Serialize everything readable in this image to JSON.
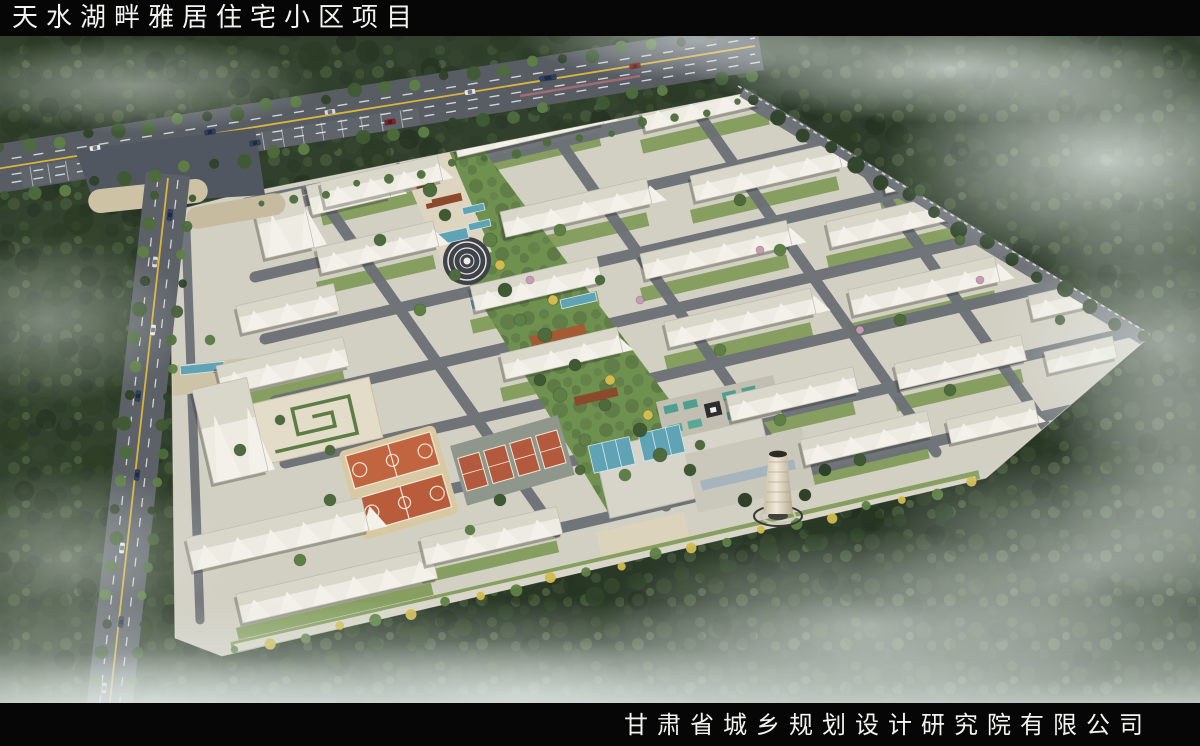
{
  "header": {
    "title": "天水湖畔雅居住宅小区项目"
  },
  "footer": {
    "company": "甘肃省城乡规划设计研究院有限公司"
  },
  "palette": {
    "bar_black": "#060606",
    "title_white": "#f3f3f0",
    "forest_green": "#31402c",
    "site_gray": "#d2cfc3",
    "road_gray": "#5a5f66",
    "lane_yellow": "#d9b53c",
    "lawn_green": "#7d9955",
    "pool_blue": "#5fa3b5",
    "court_orange": "#c0653f",
    "tennis_red": "#b35a3e",
    "pavilion_brown": "#8c4a2c",
    "fog_white": "#eef4f1"
  },
  "scene": {
    "treeColors": [
      "#3f5a33",
      "#4d6b3c",
      "#5e7f46",
      "#6f9150",
      "#d2bc4f",
      "#c79bb4",
      "#2f4229"
    ],
    "carColors": [
      "#e8e8ea",
      "#2e3e66",
      "#8a1f1f",
      "#d8d8da",
      "#31435f"
    ],
    "buildings": [
      [
        306,
        186,
        80,
        30,
        -13
      ],
      [
        320,
        182,
        120,
        26,
        -13
      ],
      [
        452,
        132,
        150,
        26,
        -13
      ],
      [
        640,
        106,
        130,
        26,
        -13
      ],
      [
        316,
        248,
        120,
        26,
        -13
      ],
      [
        500,
        212,
        150,
        26,
        -13
      ],
      [
        690,
        176,
        150,
        26,
        -13
      ],
      [
        880,
        168,
        110,
        26,
        -13
      ],
      [
        470,
        286,
        130,
        26,
        -13
      ],
      [
        640,
        254,
        150,
        26,
        -13
      ],
      [
        826,
        222,
        140,
        26,
        -13
      ],
      [
        1000,
        230,
        110,
        26,
        -13
      ],
      [
        500,
        354,
        120,
        26,
        -13
      ],
      [
        664,
        322,
        150,
        26,
        -13
      ],
      [
        848,
        290,
        150,
        26,
        -13
      ],
      [
        1028,
        296,
        90,
        24,
        -13
      ],
      [
        726,
        396,
        130,
        26,
        -13
      ],
      [
        894,
        364,
        130,
        26,
        -13
      ],
      [
        1044,
        352,
        70,
        22,
        -13
      ],
      [
        800,
        440,
        130,
        26,
        -13
      ],
      [
        946,
        420,
        90,
        24,
        -13
      ],
      [
        186,
        538,
        180,
        34,
        -13
      ],
      [
        236,
        594,
        200,
        30,
        -13
      ],
      [
        420,
        538,
        140,
        28,
        -13
      ],
      [
        216,
        366,
        130,
        30,
        -13
      ],
      [
        192,
        390,
        56,
        96,
        -13
      ],
      [
        236,
        306,
        100,
        28,
        -13
      ],
      [
        252,
        200,
        50,
        60,
        -13
      ]
    ],
    "greens": [
      [
        320,
        212,
        120,
        14,
        -13
      ],
      [
        452,
        166,
        150,
        14,
        -13
      ],
      [
        640,
        140,
        130,
        14,
        -13
      ],
      [
        316,
        282,
        120,
        14,
        -13
      ],
      [
        500,
        246,
        150,
        14,
        -13
      ],
      [
        690,
        210,
        150,
        14,
        -13
      ],
      [
        880,
        202,
        110,
        14,
        -13
      ],
      [
        470,
        320,
        130,
        14,
        -13
      ],
      [
        640,
        288,
        150,
        14,
        -13
      ],
      [
        826,
        256,
        140,
        14,
        -13
      ],
      [
        500,
        388,
        120,
        14,
        -13
      ],
      [
        664,
        356,
        150,
        14,
        -13
      ],
      [
        848,
        324,
        150,
        14,
        -13
      ],
      [
        726,
        430,
        130,
        14,
        -13
      ],
      [
        894,
        398,
        130,
        14,
        -13
      ],
      [
        800,
        474,
        130,
        14,
        -13
      ],
      [
        420,
        572,
        140,
        12,
        -13
      ],
      [
        236,
        628,
        200,
        12,
        -13
      ],
      [
        216,
        400,
        130,
        12,
        -13
      ]
    ],
    "pools": [
      [
        412,
        240,
        56,
        11,
        -13
      ],
      [
        470,
        300,
        50,
        10,
        -13
      ],
      [
        520,
        352,
        64,
        12,
        -13
      ],
      [
        560,
        300,
        36,
        9,
        -13
      ],
      [
        588,
        446,
        42,
        28,
        -13
      ],
      [
        638,
        434,
        42,
        28,
        -13
      ],
      [
        180,
        366,
        44,
        9,
        -6
      ],
      [
        462,
        208,
        22,
        7,
        -13
      ],
      [
        468,
        224,
        22,
        7,
        -13
      ]
    ],
    "trees": [
      [
        430,
        190,
        7,
        1
      ],
      [
        445,
        215,
        6,
        0
      ],
      [
        490,
        240,
        7,
        2
      ],
      [
        455,
        275,
        6,
        1
      ],
      [
        505,
        290,
        7,
        0
      ],
      [
        520,
        320,
        6,
        2
      ],
      [
        545,
        335,
        7,
        1
      ],
      [
        575,
        365,
        6,
        0
      ],
      [
        560,
        395,
        7,
        2
      ],
      [
        605,
        405,
        6,
        1
      ],
      [
        640,
        430,
        7,
        0
      ],
      [
        585,
        440,
        6,
        2
      ],
      [
        660,
        455,
        7,
        1
      ],
      [
        690,
        470,
        6,
        0
      ],
      [
        625,
        475,
        6,
        2
      ],
      [
        700,
        445,
        5,
        1
      ],
      [
        500,
        265,
        5,
        4
      ],
      [
        553,
        300,
        5,
        4
      ],
      [
        610,
        380,
        5,
        4
      ],
      [
        648,
        415,
        5,
        4
      ],
      [
        530,
        280,
        4,
        5
      ],
      [
        640,
        300,
        4,
        5
      ],
      [
        860,
        330,
        4,
        5
      ],
      [
        760,
        250,
        4,
        5
      ],
      [
        980,
        280,
        4,
        5
      ],
      [
        380,
        240,
        6,
        1
      ],
      [
        560,
        230,
        6,
        2
      ],
      [
        740,
        200,
        6,
        1
      ],
      [
        920,
        190,
        6,
        0
      ],
      [
        420,
        310,
        6,
        2
      ],
      [
        600,
        280,
        5,
        1
      ],
      [
        780,
        250,
        6,
        2
      ],
      [
        960,
        240,
        5,
        1
      ],
      [
        540,
        380,
        6,
        0
      ],
      [
        720,
        350,
        6,
        2
      ],
      [
        900,
        320,
        6,
        1
      ],
      [
        1060,
        320,
        5,
        0
      ],
      [
        780,
        420,
        6,
        2
      ],
      [
        950,
        390,
        6,
        1
      ],
      [
        860,
        460,
        6,
        0
      ],
      [
        330,
        500,
        6,
        1
      ],
      [
        300,
        560,
        6,
        2
      ],
      [
        500,
        500,
        6,
        0
      ],
      [
        240,
        450,
        6,
        1
      ],
      [
        210,
        340,
        5,
        2
      ],
      [
        280,
        420,
        5,
        1
      ],
      [
        745,
        500,
        7,
        6
      ],
      [
        805,
        495,
        6,
        6
      ],
      [
        825,
        470,
        6,
        6
      ],
      [
        330,
        450,
        5,
        1
      ],
      [
        470,
        530,
        5,
        2
      ],
      [
        580,
        470,
        5,
        1
      ]
    ],
    "treeRows": [
      [
        0,
        150,
        740,
        30,
        26,
        6,
        -1
      ],
      [
        5,
        198,
        752,
        76,
        26,
        6,
        -1
      ],
      [
        152,
        195,
        92,
        738,
        20,
        6,
        -1
      ],
      [
        190,
        198,
        128,
        738,
        20,
        5,
        -1
      ],
      [
        752,
        102,
        1142,
        338,
        16,
        7,
        6
      ],
      [
        235,
        652,
        972,
        484,
        22,
        5,
        -2
      ],
      [
        244,
        676,
        988,
        502,
        18,
        8,
        6
      ],
      [
        262,
        206,
        738,
        104,
        16,
        4,
        1
      ]
    ],
    "cars": [
      [
        95,
        148,
        -9,
        0
      ],
      [
        210,
        132,
        -9,
        1
      ],
      [
        330,
        112,
        -9,
        3
      ],
      [
        470,
        92,
        -9,
        0
      ],
      [
        548,
        78,
        -9,
        1,
        17
      ],
      [
        635,
        66,
        -9,
        2
      ],
      [
        255,
        143,
        -9,
        4
      ],
      [
        390,
        122,
        -9,
        2
      ],
      [
        170,
        215,
        97,
        1
      ],
      [
        155,
        262,
        97,
        3
      ],
      [
        153,
        330,
        97,
        0
      ],
      [
        138,
        396,
        97,
        4
      ],
      [
        137,
        475,
        97,
        1
      ],
      [
        122,
        548,
        97,
        0
      ],
      [
        121,
        622,
        97,
        4
      ],
      [
        104,
        688,
        97,
        3
      ]
    ],
    "fog": [
      [
        130,
        85,
        190,
        48,
        0.5
      ],
      [
        50,
        320,
        140,
        85,
        0.42
      ],
      [
        70,
        560,
        160,
        95,
        0.45
      ],
      [
        950,
        68,
        260,
        55,
        0.75
      ],
      [
        1110,
        160,
        230,
        115,
        0.8
      ],
      [
        1165,
        345,
        170,
        140,
        0.62
      ],
      [
        870,
        625,
        270,
        95,
        0.6
      ],
      [
        1090,
        565,
        230,
        115,
        0.6
      ],
      [
        520,
        695,
        320,
        55,
        0.5
      ],
      [
        160,
        700,
        230,
        48,
        0.5
      ],
      [
        1190,
        480,
        140,
        120,
        0.5
      ],
      [
        700,
        40,
        180,
        40,
        0.55
      ]
    ]
  }
}
